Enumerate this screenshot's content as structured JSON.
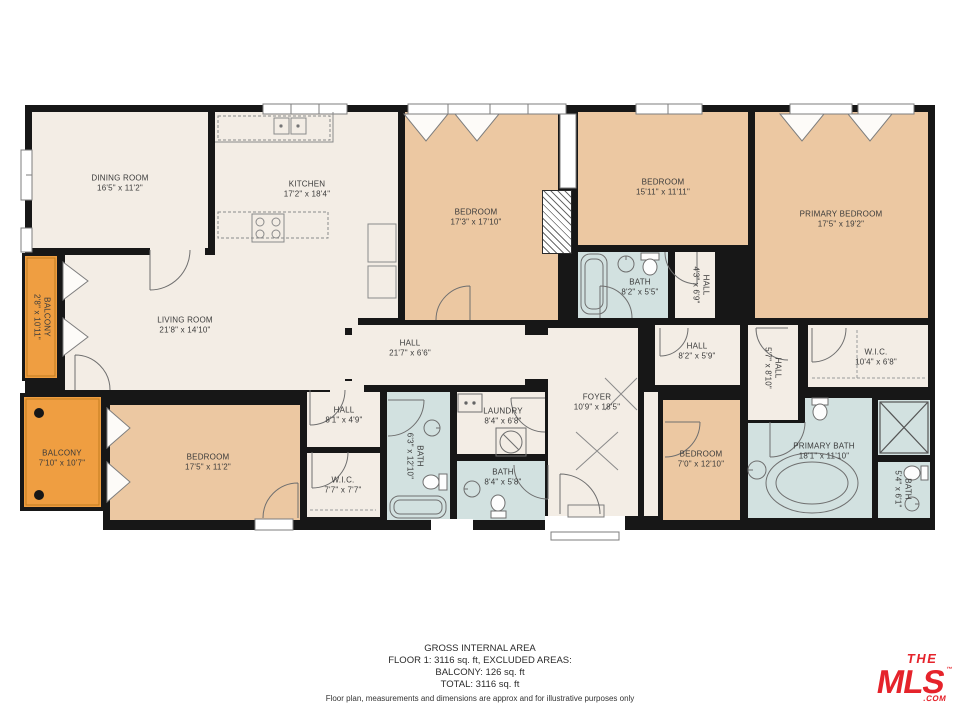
{
  "colors": {
    "wall": "#171717",
    "room_cream": "#f3ede5",
    "bedroom_tan": "#ecc8a2",
    "bath_blue": "#d2e1e0",
    "balcony_orange": "#ef9e41",
    "logo_red": "#e5232b"
  },
  "rooms": {
    "dining": {
      "name": "DINING ROOM",
      "dims": "16'5\" x 11'2\""
    },
    "kitchen": {
      "name": "KITCHEN",
      "dims": "17'2\" x 18'4\""
    },
    "bedroom1": {
      "name": "BEDROOM",
      "dims": "17'3\" x 17'10\""
    },
    "bedroom2": {
      "name": "BEDROOM",
      "dims": "15'11\" x 11'11\""
    },
    "primary_bedroom": {
      "name": "PRIMARY BEDROOM",
      "dims": "17'5\" x 19'2\""
    },
    "bath_top": {
      "name": "BATH",
      "dims": "8'2\" x 5'5\""
    },
    "hall_small_top": {
      "name": "HALL",
      "dims": "4'3\" x 6'9\""
    },
    "balcony_left": {
      "name": "BALCONY",
      "dims": "2'8\" x 10'11\""
    },
    "living": {
      "name": "LIVING ROOM",
      "dims": "21'8\" x 14'10\""
    },
    "hall_main": {
      "name": "HALL",
      "dims": "21'7\" x 6'6\""
    },
    "hall_right": {
      "name": "HALL",
      "dims": "8'2\" x 5'9\""
    },
    "hall_vert": {
      "name": "HALL",
      "dims": "5'7\" x 8'10\""
    },
    "wic_right": {
      "name": "W.I.C.",
      "dims": "10'4\" x 6'8\""
    },
    "foyer": {
      "name": "FOYER",
      "dims": "10'9\" x 18'5\""
    },
    "balcony_bottom": {
      "name": "BALCONY",
      "dims": "7'10\" x 10'7\""
    },
    "bedroom3": {
      "name": "BEDROOM",
      "dims": "17'5\" x 11'2\""
    },
    "hall_bottom": {
      "name": "HALL",
      "dims": "8'1\" x 4'9\""
    },
    "wic_bottom": {
      "name": "W.I.C.",
      "dims": "7'7\" x 7'7\""
    },
    "bath_vert": {
      "name": "BATH",
      "dims": "6'3\" x 12'10\""
    },
    "laundry": {
      "name": "LAUNDRY",
      "dims": "8'4\" x 6'8\""
    },
    "bath_bottom": {
      "name": "BATH",
      "dims": "8'4\" x 5'8\""
    },
    "bedroom4": {
      "name": "BEDROOM",
      "dims": "7'0\" x 12'10\""
    },
    "primary_bath": {
      "name": "PRIMARY BATH",
      "dims": "18'1\" x 11'10\""
    },
    "bath_small": {
      "name": "BATH",
      "dims": "5'4\" x 6'1\""
    }
  },
  "summary": {
    "title": "GROSS INTERNAL AREA",
    "line1": "FLOOR 1: 3116 sq. ft, EXCLUDED AREAS:",
    "line2": "BALCONY: 126 sq. ft",
    "line3": "TOTAL: 3116 sq. ft",
    "disclaimer": "Floor plan, measurements and dimensions are approx and for illustrative purposes only"
  },
  "logo": {
    "the": "THE",
    "mls": "MLS",
    "tm": "™",
    "com": ".COM"
  }
}
